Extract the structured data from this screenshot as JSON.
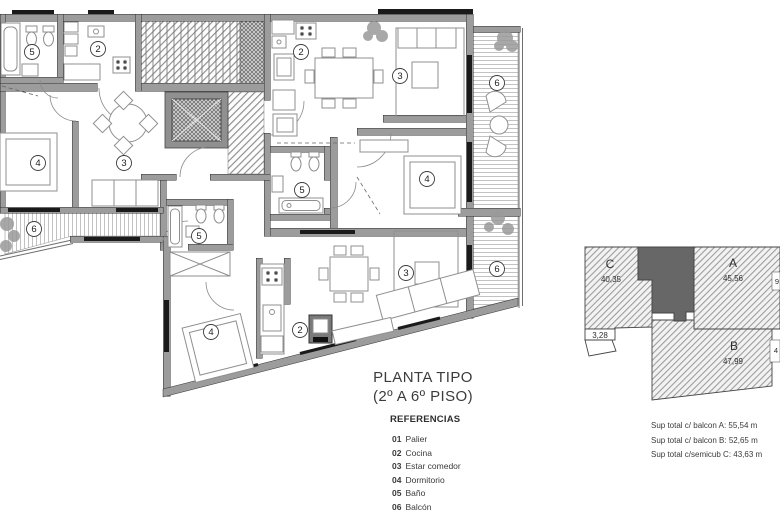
{
  "plan": {
    "title_line1": "PLANTA TIPO",
    "title_line2": "(2º A 6º PISO)",
    "legend_heading": "REFERENCIAS",
    "legend_items": [
      {
        "num": "01",
        "label": "Palier"
      },
      {
        "num": "02",
        "label": "Cocina"
      },
      {
        "num": "03",
        "label": "Estar comedor"
      },
      {
        "num": "04",
        "label": "Dormitorio"
      },
      {
        "num": "05",
        "label": "Baño"
      },
      {
        "num": "06",
        "label": "Balcón"
      }
    ],
    "room_labels": [
      {
        "n": "5",
        "x": 32,
        "y": 52
      },
      {
        "n": "2",
        "x": 98,
        "y": 49
      },
      {
        "n": "4",
        "x": 38,
        "y": 163
      },
      {
        "n": "3",
        "x": 124,
        "y": 163
      },
      {
        "n": "6",
        "x": 34,
        "y": 229
      },
      {
        "n": "5",
        "x": 199,
        "y": 236
      },
      {
        "n": "2",
        "x": 301,
        "y": 52
      },
      {
        "n": "3",
        "x": 400,
        "y": 76
      },
      {
        "n": "6",
        "x": 497,
        "y": 83
      },
      {
        "n": "4",
        "x": 427,
        "y": 179
      },
      {
        "n": "5",
        "x": 302,
        "y": 190
      },
      {
        "n": "4",
        "x": 211,
        "y": 332
      },
      {
        "n": "2",
        "x": 300,
        "y": 330
      },
      {
        "n": "3",
        "x": 406,
        "y": 273
      },
      {
        "n": "6",
        "x": 497,
        "y": 269
      }
    ]
  },
  "key_plan": {
    "units": [
      {
        "id": "C",
        "area": "40,35",
        "id_x": 610,
        "id_y": 268,
        "area_x": 611,
        "area_y": 282
      },
      {
        "id": "A",
        "area": "45,56",
        "id_x": 733,
        "id_y": 267,
        "area_x": 733,
        "area_y": 281
      },
      {
        "id": "B",
        "area": "47,99",
        "id_x": 734,
        "id_y": 350,
        "area_x": 733,
        "area_y": 364
      }
    ],
    "extra_area": {
      "value": "3,28",
      "x": 600,
      "y": 338
    },
    "edge_labels": [
      {
        "value": "9",
        "x": 777,
        "y": 284
      },
      {
        "value": "4",
        "x": 776,
        "y": 353
      }
    ]
  },
  "summary": {
    "lines": [
      "Sup total c/ balcon A:  55,54 m",
      "Sup total c/ balcon B:  52,65 m",
      "Sup total c/semicub C:  43,63 m"
    ]
  },
  "colors": {
    "wall": "#9c9c9c",
    "core_dark": "#676767",
    "line": "#2f2f2f"
  }
}
